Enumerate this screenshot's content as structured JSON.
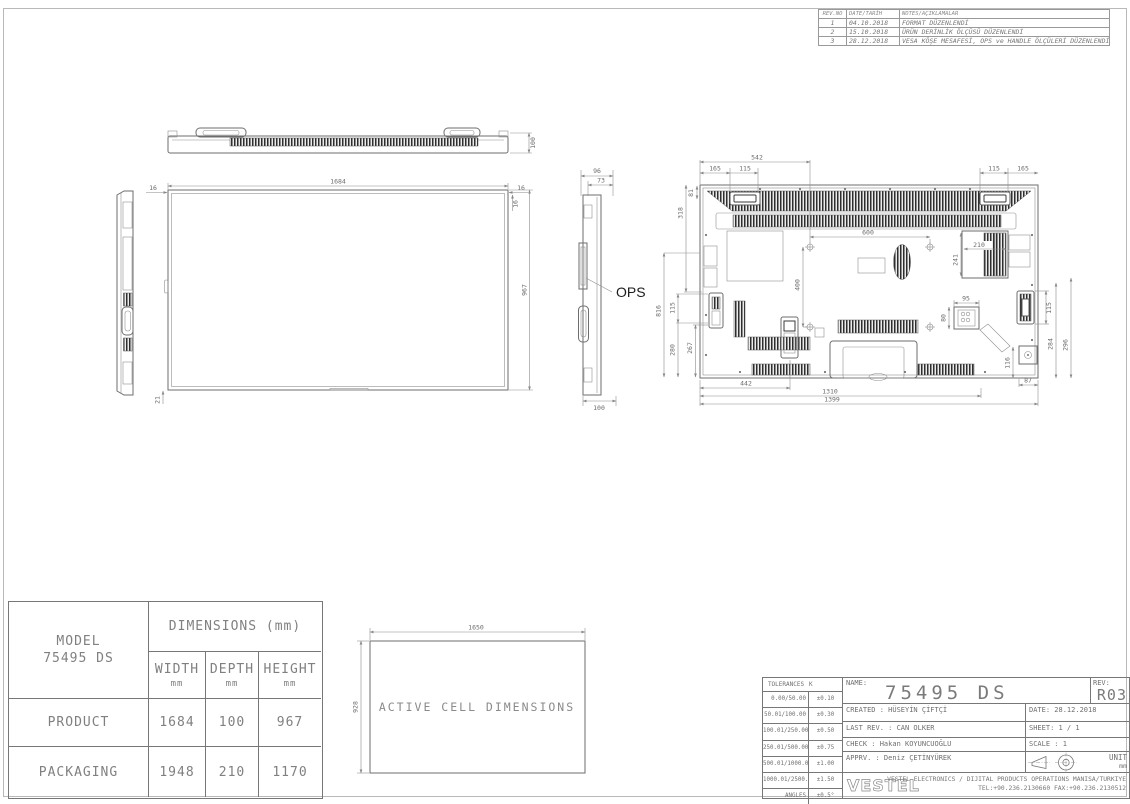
{
  "revision_table": {
    "headers": [
      "REV.NO",
      "DATE/TARİH",
      "NOTES/AÇIKLAMALAR"
    ],
    "rows": [
      {
        "no": "1",
        "date": "04.10.2018",
        "note": "FORMAT DÜZENLENDİ"
      },
      {
        "no": "2",
        "date": "15.10.2018",
        "note": "ÜRÜN DERİNLİK ÖLÇÜSÜ DÜZENLENDİ"
      },
      {
        "no": "3",
        "date": "28.12.2018",
        "note": "VESA KÖŞE MESAFESİ, OPS ve HANDLE ÖLÇÜLERİ DÜZENLENDİ"
      }
    ]
  },
  "drawing": {
    "ops_label": "OPS",
    "top_view": {
      "depth": "100"
    },
    "front_view": {
      "width": "1684",
      "height": "967",
      "bezel_left": "16",
      "bezel_right": "16",
      "bezel_top_right": "16",
      "bottom": "21"
    },
    "side_view": {
      "total_depth": "96",
      "body_depth": "73",
      "depth": "100"
    },
    "back_view": {
      "vesa_offset": "542",
      "top_left_165": "165",
      "top_left_115": "115",
      "top_right_115": "115",
      "top_right_165": "165",
      "corner_81": "81",
      "left_318": "318",
      "left_816": "816",
      "mid_115": "115",
      "mid_280": "280",
      "mid_267": "267",
      "vesa_width": "600",
      "vesa_height": "400",
      "vent_210": "210",
      "vent_241": "241",
      "conn_95": "95",
      "conn_80": "80",
      "handle_115": "115",
      "right_284": "284",
      "right_296": "296",
      "right_116": "116",
      "right_87": "87",
      "bottom_442": "442",
      "bottom_1310": "1310",
      "bottom_1399": "1399"
    },
    "active_cell": {
      "label": "ACTIVE CELL DIMENSIONS",
      "width": "1650",
      "height": "928"
    }
  },
  "dimensions_table": {
    "model_label": "MODEL",
    "model": "75495 DS",
    "header": "DIMENSIONS (mm)",
    "columns": [
      {
        "label": "WIDTH",
        "unit": "mm"
      },
      {
        "label": "DEPTH",
        "unit": "mm"
      },
      {
        "label": "HEIGHT",
        "unit": "mm"
      }
    ],
    "rows": [
      {
        "label": "PRODUCT",
        "width": "1684",
        "depth": "100",
        "height": "967"
      },
      {
        "label": "PACKAGING",
        "width": "1948",
        "depth": "210",
        "height": "1170"
      }
    ]
  },
  "title_block": {
    "tolerances": {
      "header_label": "TOLERANCES",
      "header_value": "K",
      "rows": [
        [
          "0.00/50.00",
          "±0.10"
        ],
        [
          "50.01/100.00",
          "±0.30"
        ],
        [
          "100.01/250.00",
          "±0.50"
        ],
        [
          "250.01/500.00",
          "±0.75"
        ],
        [
          "500.01/1000.00",
          "±1.00"
        ],
        [
          "1000.01/2500.00",
          "±1.50"
        ],
        [
          "ANGLES",
          "±0.5°"
        ]
      ]
    },
    "name_label": "NAME:",
    "name": "75495 DS",
    "rev_label": "REV:",
    "rev": "R03",
    "created": "CREATED : HÜSEYİN ÇİFTÇİ",
    "date": "DATE: 28.12.2018",
    "last_rev": "LAST REV. : CAN OLKER",
    "sheet": "SHEET: 1 / 1",
    "check": "CHECK : Hakan KOYUNCUOĞLU",
    "scale": "SCALE : 1",
    "apprv": "APPRV. : Deniz ÇETİNYÜREK",
    "unit_label": "UNIT",
    "unit": "mm",
    "logo": "VESTEL",
    "company_line1": "VESTEL ELECTRONICS / DIJITAL PRODUCTS OPERATIONS MANISA/TURKIYE",
    "company_line2": "TEL:+90.236.2130660 FAX:+90.236.2130512"
  }
}
